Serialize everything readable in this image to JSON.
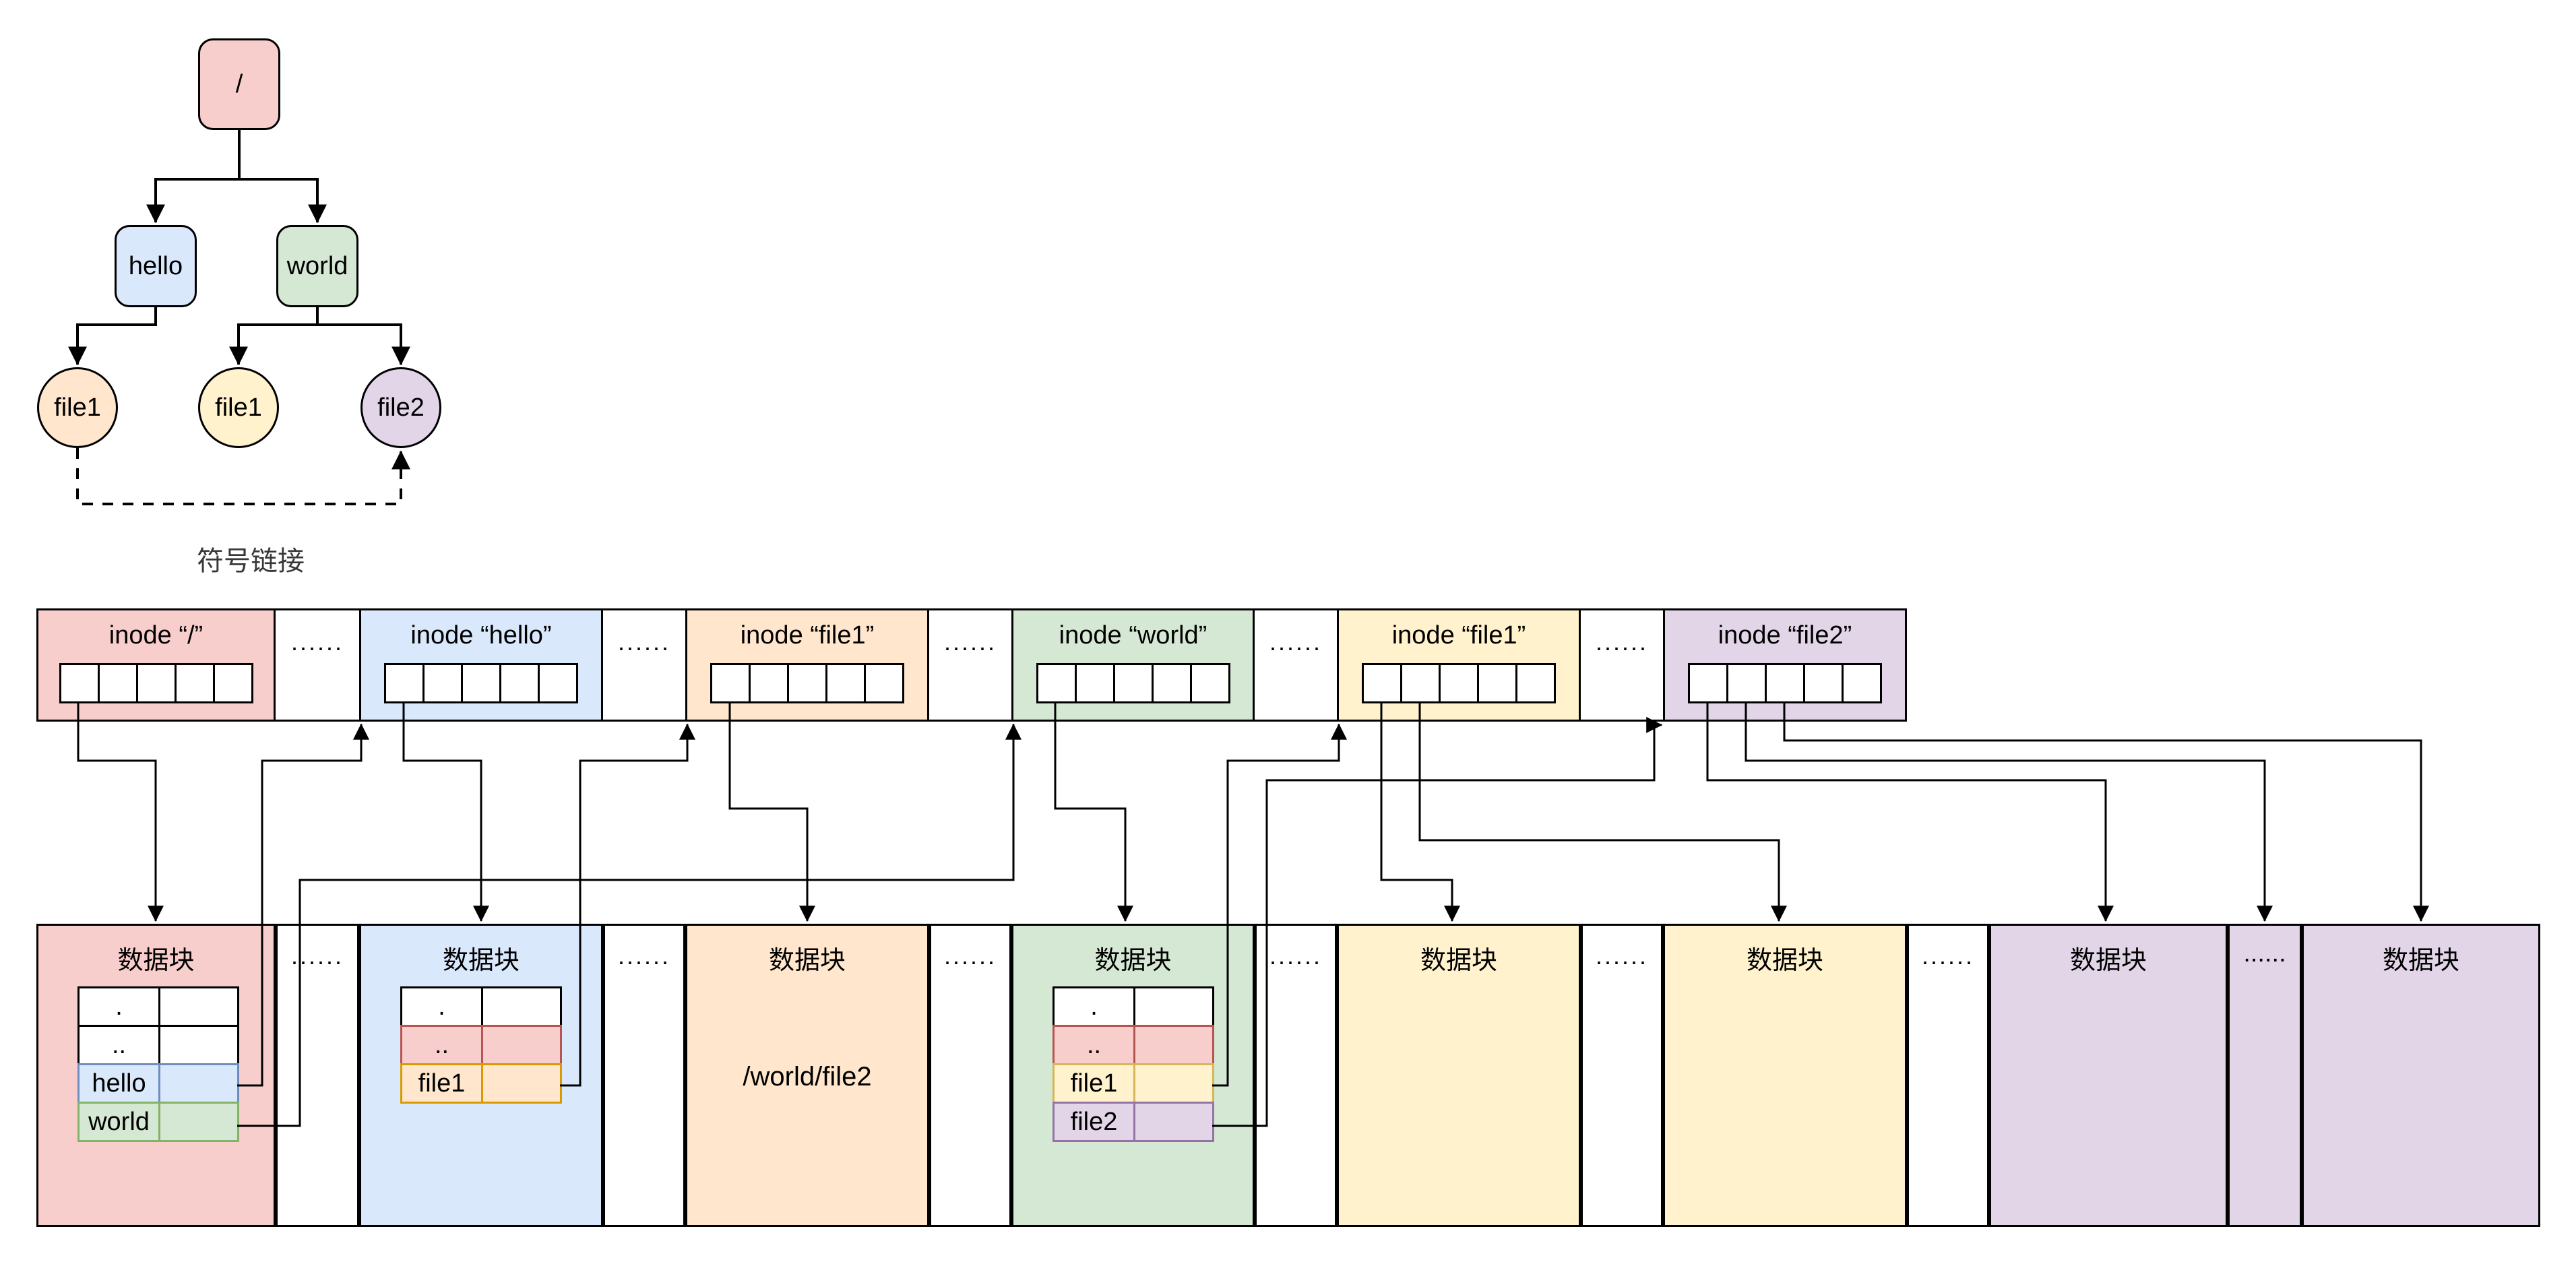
{
  "palette": {
    "red": {
      "fill": "#f8cecc",
      "stroke": "#b85450"
    },
    "blue": {
      "fill": "#dae8fc",
      "stroke": "#6c8ebf"
    },
    "green": {
      "fill": "#d5e8d4",
      "stroke": "#82b366"
    },
    "orange": {
      "fill": "#ffe6cc",
      "stroke": "#d79b00"
    },
    "yellow": {
      "fill": "#fff2cc",
      "stroke": "#d6b656"
    },
    "purple": {
      "fill": "#e1d5e7",
      "stroke": "#9673a6"
    },
    "line": "#000000",
    "background": "#ffffff"
  },
  "tree": {
    "nodes": [
      {
        "id": "root",
        "label": "/",
        "shape": "rounded-box",
        "color": "red"
      },
      {
        "id": "hello",
        "label": "hello",
        "shape": "rounded-box",
        "color": "blue"
      },
      {
        "id": "world",
        "label": "world",
        "shape": "rounded-box",
        "color": "green"
      },
      {
        "id": "file1-hello",
        "label": "file1",
        "shape": "circle",
        "color": "orange"
      },
      {
        "id": "file1-world",
        "label": "file1",
        "shape": "circle",
        "color": "yellow"
      },
      {
        "id": "file2-world",
        "label": "file2",
        "shape": "circle",
        "color": "purple"
      }
    ],
    "edges": [
      {
        "from": "root",
        "to": "hello"
      },
      {
        "from": "root",
        "to": "world"
      },
      {
        "from": "hello",
        "to": "file1-hello"
      },
      {
        "from": "world",
        "to": "file1-world"
      },
      {
        "from": "world",
        "to": "file2-world"
      }
    ],
    "symlink": {
      "from": "file1-hello",
      "to": "file2-world",
      "label": "符号链接",
      "style": "dashed"
    }
  },
  "inode_row": {
    "gap_label": "......",
    "pointer_slots_per_inode": 5,
    "boxes": [
      {
        "id": "inode-root",
        "title": "inode “/”",
        "color": "red"
      },
      {
        "id": "inode-hello",
        "title": "inode “hello”",
        "color": "blue"
      },
      {
        "id": "inode-file1-hello",
        "title": "inode “file1”",
        "color": "orange"
      },
      {
        "id": "inode-world",
        "title": "inode “world”",
        "color": "green"
      },
      {
        "id": "inode-file1-world",
        "title": "inode “file1”",
        "color": "yellow"
      },
      {
        "id": "inode-file2",
        "title": "inode “file2”",
        "color": "purple"
      }
    ]
  },
  "data_row": {
    "gap_label": "......",
    "blocks": [
      {
        "id": "block-root",
        "title": "数据块",
        "color": "red",
        "entries": [
          {
            "name": ".",
            "color": "white"
          },
          {
            "name": "..",
            "color": "white"
          },
          {
            "name": "hello",
            "color": "blue"
          },
          {
            "name": "world",
            "color": "green"
          }
        ]
      },
      {
        "id": "block-hello",
        "title": "数据块",
        "color": "blue",
        "entries": [
          {
            "name": ".",
            "color": "white"
          },
          {
            "name": "..",
            "color": "pink"
          },
          {
            "name": "file1",
            "color": "orange"
          }
        ]
      },
      {
        "id": "block-file1-symlink",
        "title": "数据块",
        "color": "orange",
        "content": "/world/file2"
      },
      {
        "id": "block-world",
        "title": "数据块",
        "color": "green",
        "entries": [
          {
            "name": ".",
            "color": "white"
          },
          {
            "name": "..",
            "color": "pink"
          },
          {
            "name": "file1",
            "color": "yellow"
          },
          {
            "name": "file2",
            "color": "purple"
          }
        ]
      },
      {
        "id": "block-file1-a",
        "title": "数据块",
        "color": "yellow"
      },
      {
        "id": "block-file1-b",
        "title": "数据块",
        "color": "yellow"
      },
      {
        "id": "block-file2-a",
        "title": "数据块",
        "color": "purple"
      },
      {
        "id": "block-file2-mid",
        "label": "......",
        "color": "purple"
      },
      {
        "id": "block-file2-b",
        "title": "数据块",
        "color": "purple"
      }
    ]
  },
  "connections": {
    "inode_pointers": [
      {
        "from": "inode-root slot 1",
        "to": "block-root"
      },
      {
        "from": "inode-hello slot 1",
        "to": "block-hello"
      },
      {
        "from": "inode-file1-hello slot 1",
        "to": "block-file1-symlink"
      },
      {
        "from": "inode-world slot 1",
        "to": "block-world"
      },
      {
        "from": "inode-file1-world slot 1",
        "to": "block-file1-a"
      },
      {
        "from": "inode-file1-world slot 2",
        "to": "block-file1-b"
      },
      {
        "from": "inode-file2 slot 1",
        "to": "block-file2-a"
      },
      {
        "from": "inode-file2 slot 2",
        "to": "block-file2-mid"
      },
      {
        "from": "inode-file2 slot 3",
        "to": "block-file2-b"
      }
    ],
    "directory_entries": [
      {
        "from": "block-root entry hello",
        "to": "inode-hello"
      },
      {
        "from": "block-root entry world",
        "to": "inode-world"
      },
      {
        "from": "block-hello entry file1",
        "to": "inode-file1-hello"
      },
      {
        "from": "block-world entry file1",
        "to": "inode-file1-world"
      },
      {
        "from": "block-world entry file2",
        "to": "inode-file2"
      }
    ]
  }
}
